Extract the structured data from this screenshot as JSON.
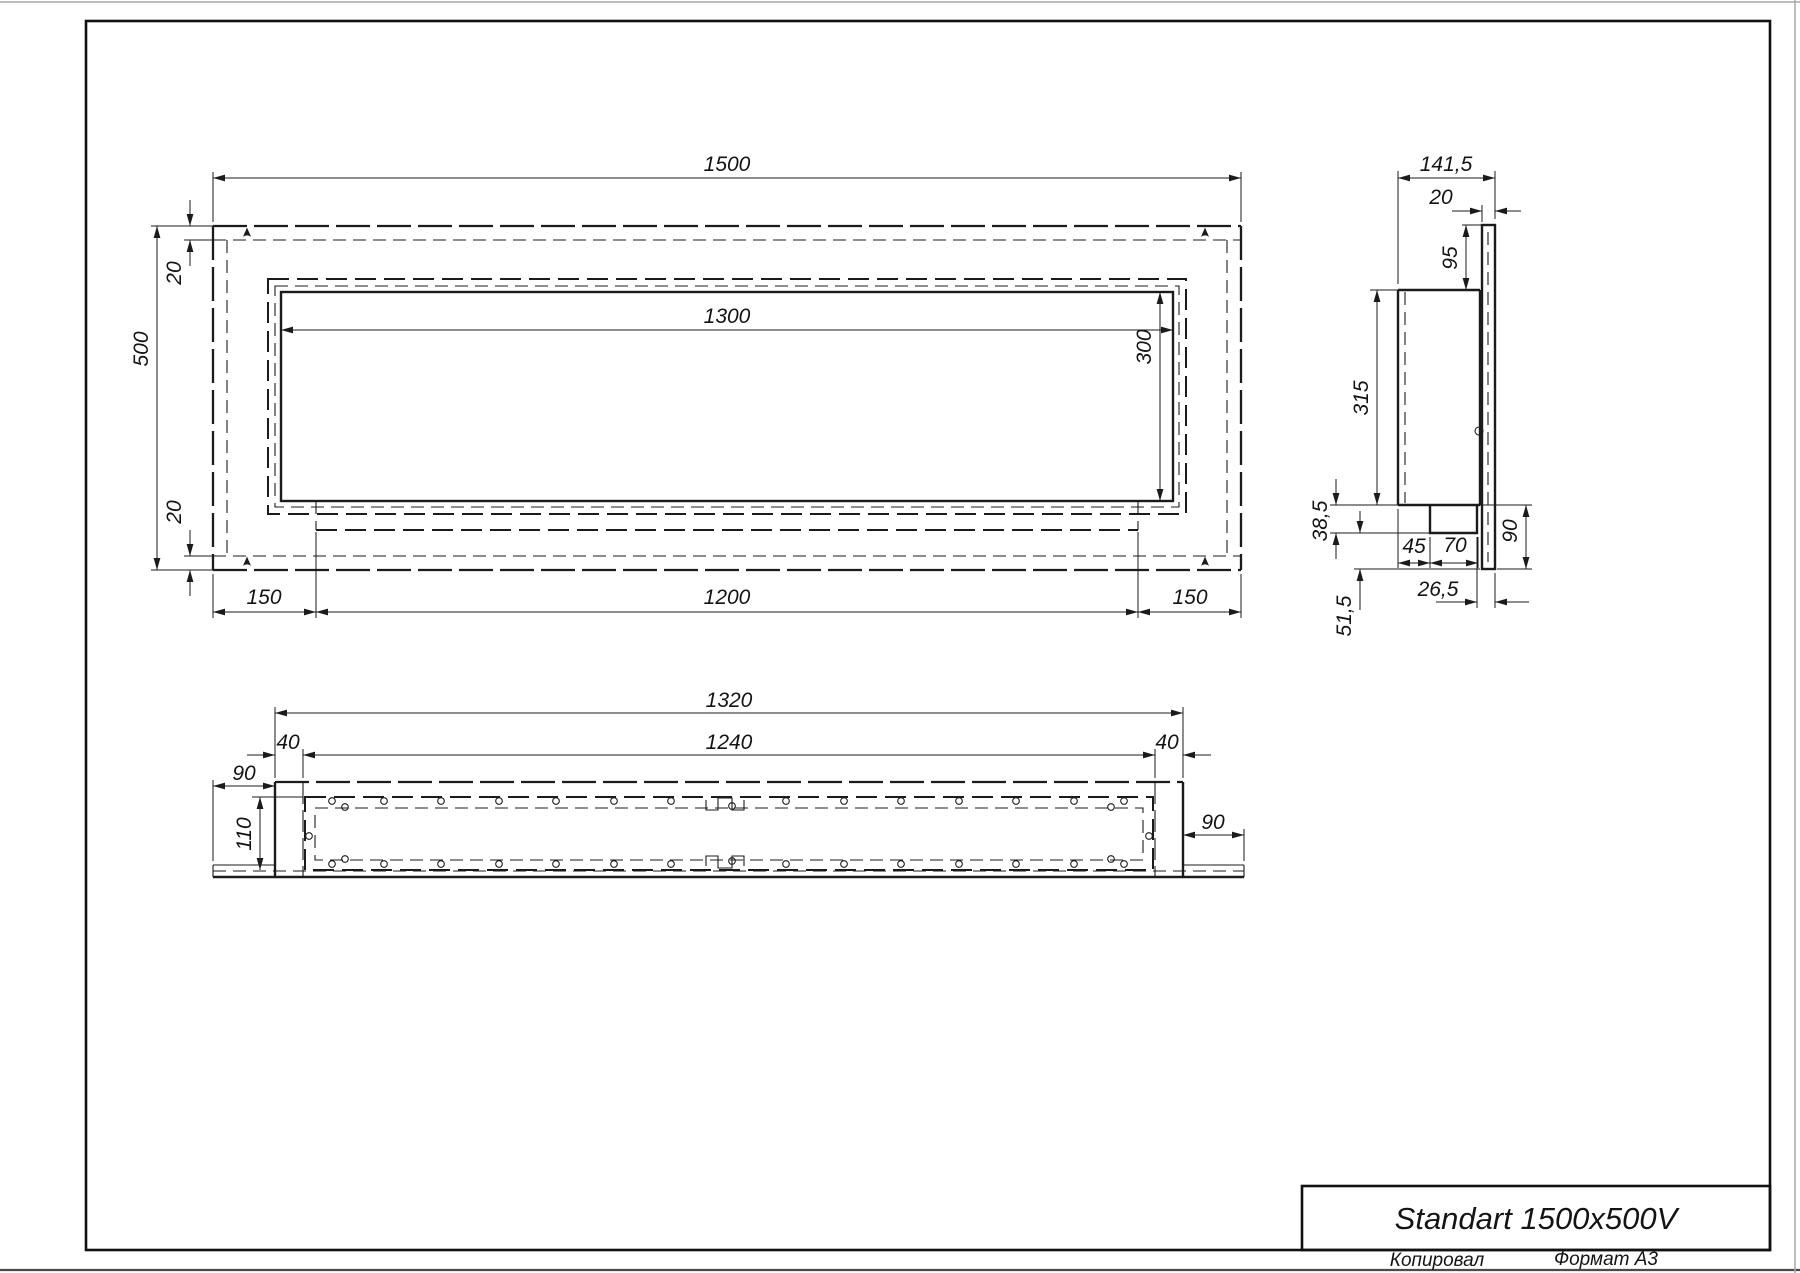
{
  "title_block": {
    "product": "Standart 1500x500V",
    "copied_by": "Копировал",
    "format": "Формат А3"
  },
  "front_view": {
    "overall_width": "1500",
    "overall_height": "500",
    "opening_width": "1300",
    "opening_height": "300",
    "flange_top": "20",
    "flange_bottom": "20",
    "offset_left": "150",
    "base_width": "1200",
    "offset_right": "150"
  },
  "side_view": {
    "overall_depth": "141,5",
    "front_panel": "20",
    "top_offset": "95",
    "body_height": "315",
    "tray_height": "38,5",
    "tray_inset": "45",
    "tray_width": "70",
    "bottom_flange": "90",
    "back_gap": "26,5",
    "bottom_offset": "51,5"
  },
  "bottom_view": {
    "body_width": "1320",
    "burner_width": "1240",
    "wall_left": "40",
    "wall_right": "40",
    "end_left": "90",
    "end_right": "90",
    "burner_depth": "110"
  }
}
